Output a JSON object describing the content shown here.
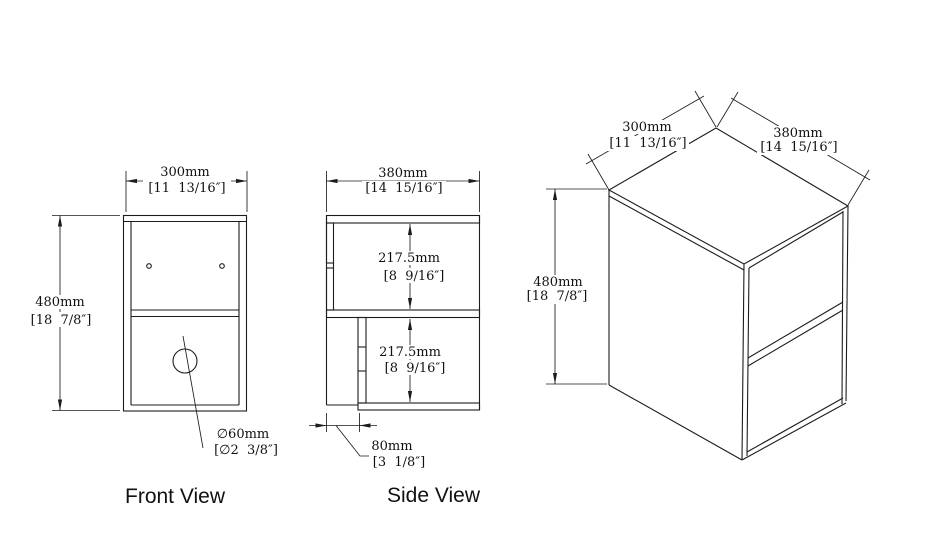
{
  "front": {
    "label": "Front View",
    "width_mm": "300mm",
    "width_in": "[11  13/16″]",
    "height_mm": "480mm",
    "height_in": "[18  7/8″]",
    "hole_mm": "∅60mm",
    "hole_in": "[∅2  3/8″]"
  },
  "side": {
    "label": "Side View",
    "width_mm": "380mm",
    "width_in": "[14  15/16″]",
    "upper_mm": "217.5mm",
    "upper_in": "[8  9/16″]",
    "lower_mm": "217.5mm",
    "lower_in": "[8  9/16″]",
    "recess_mm": "80mm",
    "recess_in": "[3  1/8″]"
  },
  "iso": {
    "depth_mm": "300mm",
    "depth_in": "[11  13/16″]",
    "width_mm": "380mm",
    "width_in": "[14  15/16″]",
    "height_mm": "480mm",
    "height_in": "[18  7/8″]"
  },
  "colors": {
    "line": "#1c1c1c",
    "background": "#ffffff"
  }
}
